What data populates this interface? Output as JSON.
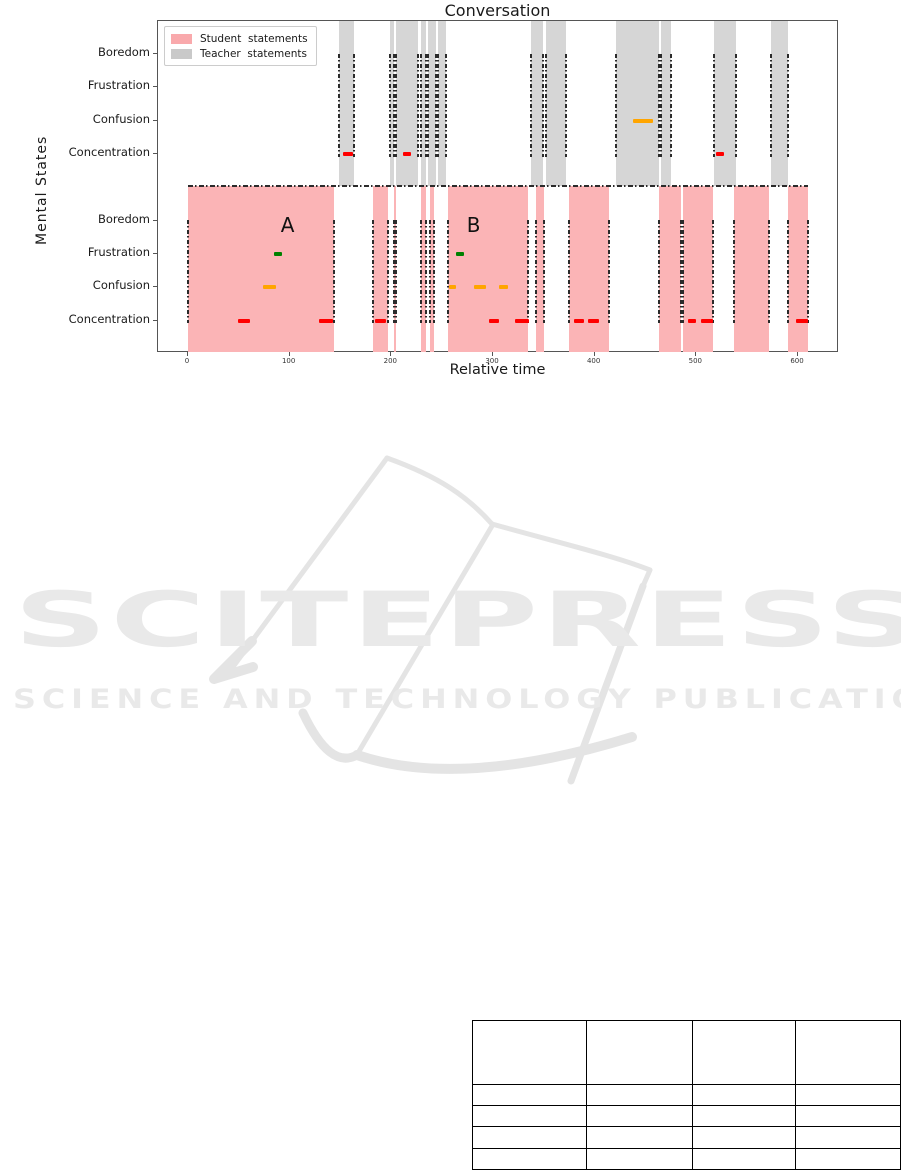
{
  "chart": {
    "title": "Conversation",
    "xlabel": "Relative time",
    "ylabel": "Mental States"
  },
  "chart_data": {
    "type": "timeline",
    "title": "Conversation",
    "xlabel": "Relative time",
    "ylabel": "Mental States",
    "x_ticks": [
      0,
      100,
      200,
      300,
      400,
      500,
      600
    ],
    "x_range": [
      -30,
      640
    ],
    "rows_teacher": [
      "Boredom",
      "Frustration",
      "Confusion",
      "Concentration"
    ],
    "rows_student": [
      "Boredom",
      "Frustration",
      "Confusion",
      "Concentration"
    ],
    "legend": [
      {
        "label": "Student  statements",
        "color": "#f9a9ac"
      },
      {
        "label": "Teacher  statements",
        "color": "#c9c9c9"
      }
    ],
    "teacher_bands": [
      [
        149,
        163
      ],
      [
        199,
        203
      ],
      [
        205,
        226
      ],
      [
        229,
        234
      ],
      [
        236,
        244
      ],
      [
        246,
        254
      ],
      [
        337,
        349
      ],
      [
        352,
        372
      ],
      [
        421,
        463
      ],
      [
        465,
        475
      ],
      [
        517,
        539
      ],
      [
        573,
        590
      ]
    ],
    "student_bands": [
      [
        0,
        144
      ],
      [
        182,
        197
      ],
      [
        203,
        205
      ],
      [
        229,
        234
      ],
      [
        238,
        242
      ],
      [
        256,
        334
      ],
      [
        342,
        350
      ],
      [
        375,
        414
      ],
      [
        463,
        485
      ],
      [
        487,
        516
      ],
      [
        537,
        571
      ],
      [
        590,
        610
      ]
    ],
    "divider_span": [
      0,
      610
    ],
    "markers": {
      "teacher_confusion": [
        [
          438,
          457
        ]
      ],
      "teacher_concentration": [
        [
          152,
          162
        ],
        [
          211,
          219
        ],
        [
          519,
          527
        ]
      ],
      "student_frustration": [
        [
          85,
          92
        ],
        [
          264,
          271
        ]
      ],
      "student_confusion": [
        [
          74,
          87
        ],
        [
          257,
          264
        ],
        [
          281,
          293
        ],
        [
          306,
          315
        ]
      ],
      "student_concentration": [
        [
          49,
          61
        ],
        [
          129,
          143
        ],
        [
          184,
          195
        ],
        [
          296,
          306
        ],
        [
          322,
          335
        ],
        [
          380,
          390
        ],
        [
          393,
          404
        ],
        [
          492,
          500
        ],
        [
          505,
          516
        ],
        [
          598,
          610
        ]
      ]
    },
    "annotations": [
      {
        "label": "A",
        "x": 98
      },
      {
        "label": "B",
        "x": 281
      }
    ],
    "colors": {
      "student_band": "#fbb4b6",
      "teacher_band": "#d6d6d6",
      "concentration_marker": "#ff0000",
      "confusion_marker": "#ffa500",
      "frustration_marker": "#008000"
    }
  },
  "watermark": {
    "line1": "SCITEPRESS",
    "line2": "SCIENCE AND TECHNOLOGY PUBLICATIONS",
    "color": "#e9e9e9"
  },
  "table": {
    "rows": 5,
    "cols": 4,
    "col_widths": [
      114,
      105,
      103,
      104
    ],
    "row_heights": [
      64,
      21,
      21,
      22,
      21
    ],
    "cells": [
      [
        "",
        "",
        "",
        ""
      ],
      [
        "",
        "",
        "",
        ""
      ],
      [
        "",
        "",
        "",
        ""
      ],
      [
        "",
        "",
        "",
        ""
      ],
      [
        "",
        "",
        "",
        ""
      ]
    ]
  }
}
